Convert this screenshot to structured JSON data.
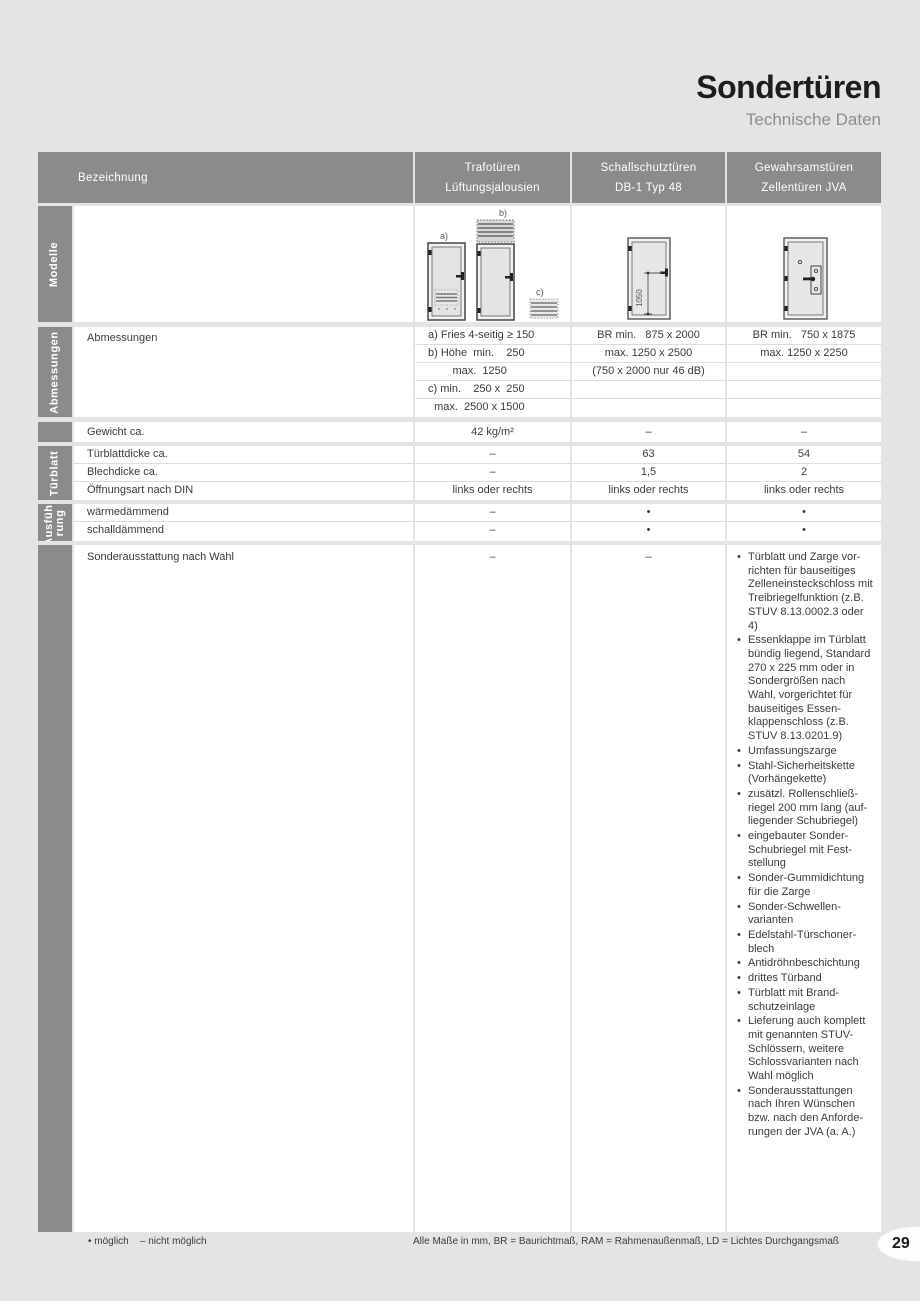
{
  "page": {
    "title": "Sondertüren",
    "subtitle": "Technische Daten",
    "page_number": "29"
  },
  "colors": {
    "header_gray": "#8b8b8d",
    "page_bg": "#e4e4e6",
    "text": "#3b3b3c",
    "separator": "#dcdcdd"
  },
  "header": {
    "col0": "Bezeichnung",
    "col1_line1": "Trafotüren",
    "col1_line2": "Lüftungsjalousien",
    "col2_line1": "Schallschutztüren",
    "col2_line2": "DB-1 Typ 48",
    "col3_line1": "Gewahrsamstüren",
    "col3_line2": "Zellentüren JVA"
  },
  "sidebar": {
    "modelle": "Modelle",
    "abmessungen": "Abmessungen",
    "tuerblatt": "Türblatt",
    "ausfuehrung_line1": "Ausfüh-",
    "ausfuehrung_line2": "rung"
  },
  "models": {
    "label_a": "a)",
    "label_b": "b)",
    "label_c": "c)",
    "dim": "1050"
  },
  "abmessungen": {
    "label": "Abmessungen",
    "col1": [
      "a) Fries 4-seitig ≥ 150",
      "b) Höhe  min.    250",
      "        max.  1250",
      "c) min.    250 x  250",
      "  max.  2500 x 1500"
    ],
    "col2": [
      "BR min.   875 x 2000",
      "max. 1250 x 2500",
      "(750 x 2000 nur 46 dB)",
      "",
      ""
    ],
    "col3": [
      "BR min.   750 x 1875",
      "max. 1250 x 2250",
      "",
      "",
      ""
    ]
  },
  "gewicht": {
    "label": "Gewicht ca.",
    "v1": "42 kg/m²",
    "v2": "–",
    "v3": "–"
  },
  "tuerblatt": {
    "rows": [
      {
        "label": "Türblattdicke ca.",
        "v1": "–",
        "v2": "63",
        "v3": "54"
      },
      {
        "label": "Blechdicke ca.",
        "v1": "–",
        "v2": "1,5",
        "v3": "2"
      },
      {
        "label": "Öffnungsart nach DIN",
        "v1": "links oder rechts",
        "v2": "links oder rechts",
        "v3": "links oder rechts"
      }
    ]
  },
  "ausfuehrung": {
    "rows": [
      {
        "label": "wärmedämmend",
        "v1": "–",
        "v2": "•",
        "v3": "•"
      },
      {
        "label": "schalldämmend",
        "v1": "–",
        "v2": "•",
        "v3": "•"
      }
    ]
  },
  "sonder": {
    "label": "Sonderausstattung nach Wahl",
    "v1": "–",
    "v2": "–",
    "items": [
      "Türblatt und Zarge vor­richten für bauseitiges Zelleneinsteckschloss mit Treibriegelfunktion (z.B. STUV 8.13.0002.3 oder 4)",
      "Essenklappe im Tür­blatt bündig liegend, Standard 270 x 225 mm oder in Sondergrößen nach Wahl, vorgerichtet für bauseitiges Essen­klappenschloss (z.B. STUV 8.13.0201.9)",
      "Umfassungszarge",
      "Stahl-Sicherheitskette (Vorhängekette)",
      "zusätzl. Rollenschließ­riegel 200 mm lang (auf­liegender Schubriegel)",
      "eingebauter Sonder-Schubriegel mit Fest­stellung",
      "Sonder-Gummidichtung für die Zarge",
      "Sonder-Schwellen­varianten",
      "Edelstahl-Türschoner­blech",
      "Antidröhnbeschichtung",
      "drittes Türband",
      "Türblatt mit Brand­schutzeinlage",
      "Lieferung auch komplett mit genannten STUV-Schlössern, weitere Schlossvarianten nach Wahl möglich",
      "Sonderausstattungen nach Ihren Wünschen bzw. nach den Anforde­rungen der JVA (a. A.)"
    ]
  },
  "footer": {
    "legend": "• möglich    – nicht möglich",
    "note": "Alle Maße in mm, BR = Baurichtmaß, RAM = Rahmenaußenmaß, LD = Lichtes Durchgangsmaß"
  }
}
